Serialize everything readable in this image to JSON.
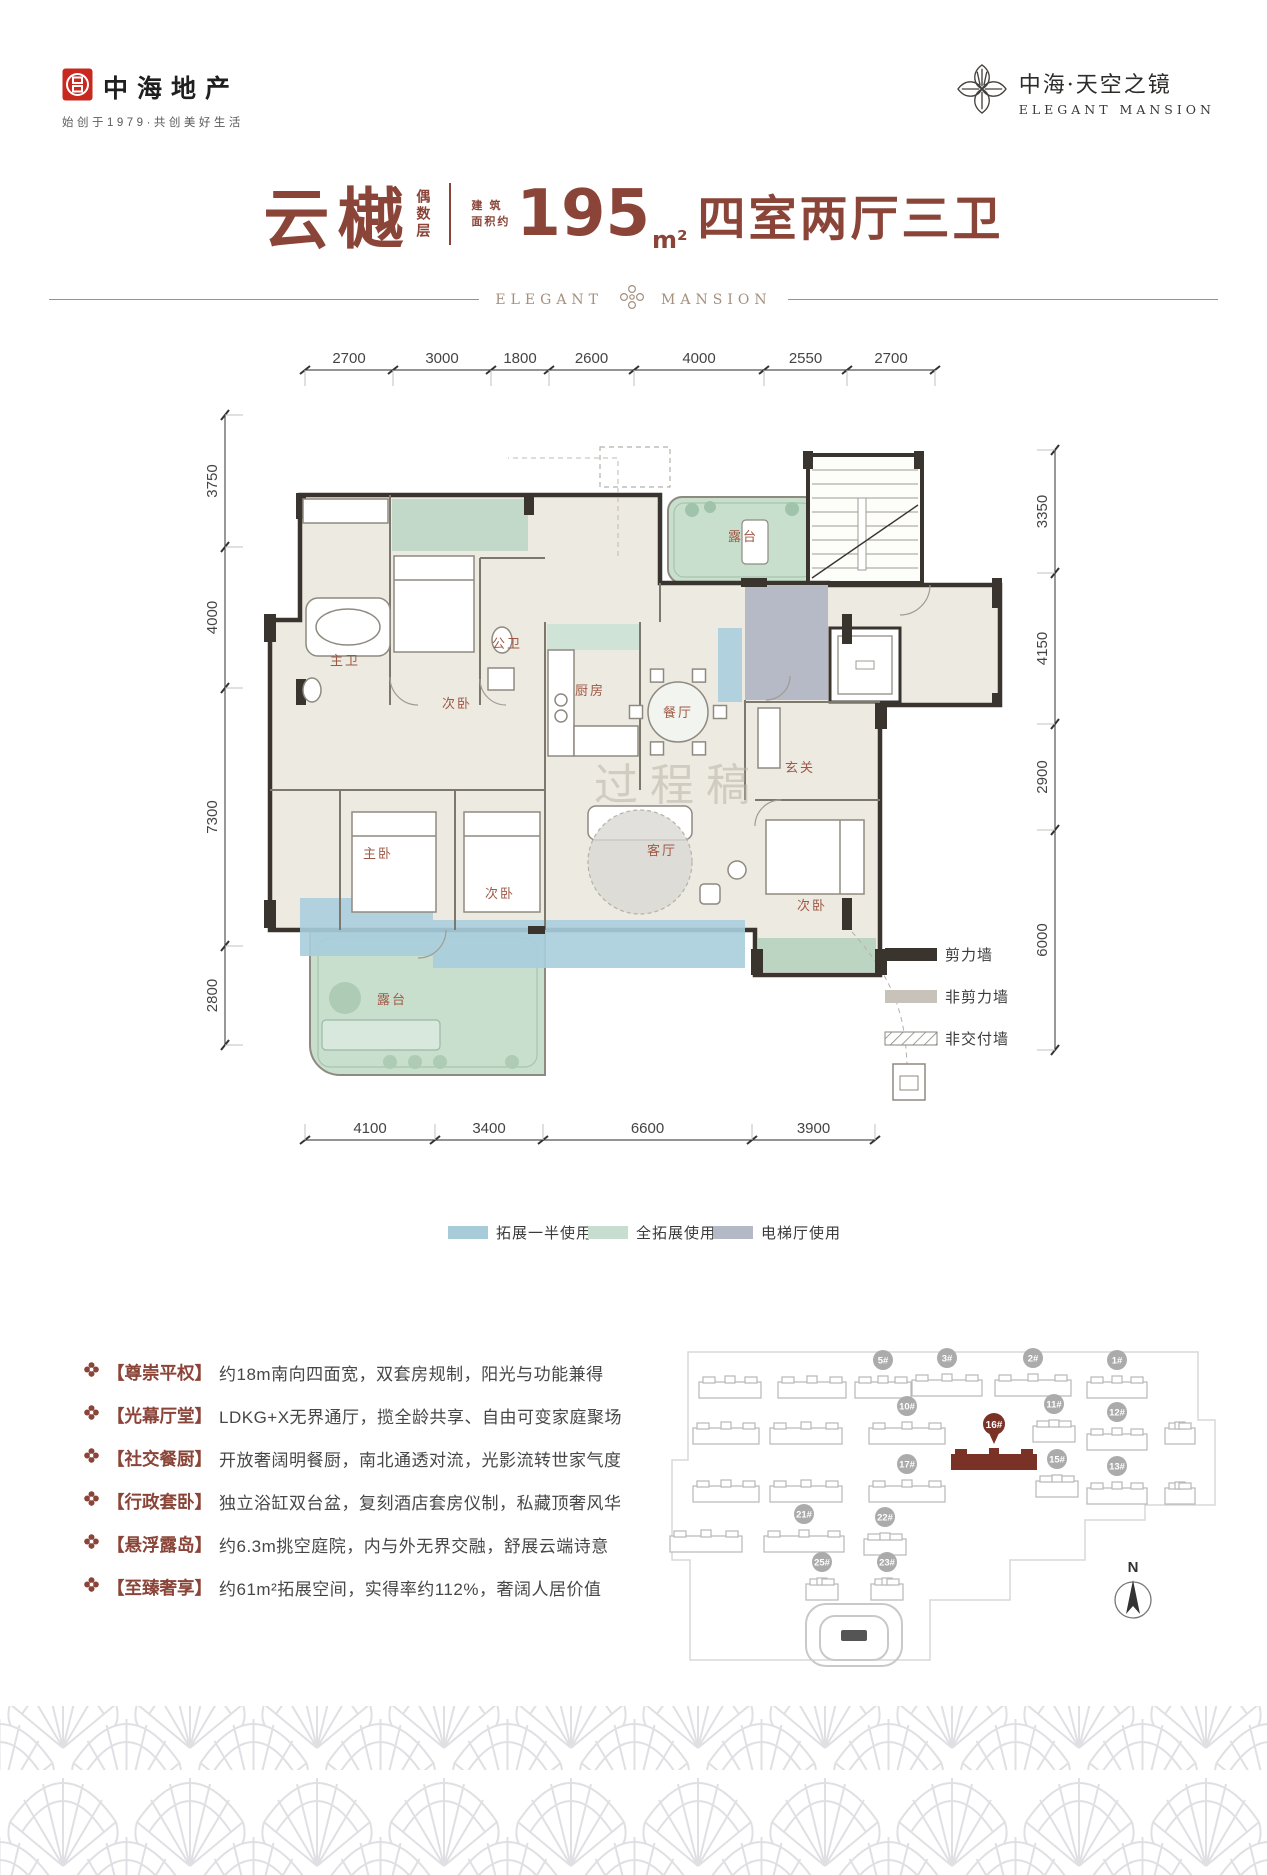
{
  "brand": {
    "name": "中海地产",
    "tagline": "始创于1979·共创美好生活"
  },
  "project": {
    "name_cn": "中海·天空之镜",
    "name_en": "ELEGANT MANSION"
  },
  "title": {
    "product": "云樾",
    "floor_note": "偶数层",
    "area_prefix_l1": "建 筑",
    "area_prefix_l2": "面积约",
    "area_value": "195",
    "area_unit": "m²",
    "layout": "四室两厅三卫",
    "banner_left": "ELEGANT",
    "banner_right": "MANSION"
  },
  "plan": {
    "watermark": "过程稿",
    "rooms": [
      "露台",
      "主卫",
      "次卧",
      "公卫",
      "厨房",
      "餐厅",
      "玄关",
      "主卧",
      "次卧",
      "客厅",
      "次卧",
      "露台"
    ],
    "dims": {
      "top": [
        "2700",
        "3000",
        "1800",
        "2600",
        "4000",
        "2550",
        "2700"
      ],
      "left": [
        "3750",
        "4000",
        "7300",
        "2800"
      ],
      "right": [
        "3350",
        "4150",
        "2900",
        "6000"
      ],
      "bottom": [
        "4100",
        "3400",
        "6600",
        "3900"
      ]
    },
    "wall_legend": [
      "剪力墙",
      "非剪力墙",
      "非交付墙"
    ],
    "zone_legend": [
      {
        "label": "拓展一半使用",
        "color": "#a8cbd9"
      },
      {
        "label": "全拓展使用",
        "color": "#c7ddd0"
      },
      {
        "label": "电梯厅使用",
        "color": "#b4b9c6"
      }
    ]
  },
  "features": [
    {
      "head": "【尊崇平权】",
      "text": "约18m南向四面宽，双套房规制，阳光与功能兼得"
    },
    {
      "head": "【光幕厅堂】",
      "text": "LDKG+X无界通厅，揽全龄共享、自由可变家庭聚场"
    },
    {
      "head": "【社交餐厨】",
      "text": "开放奢阔明餐厨，南北通透对流，光影流转世家气度"
    },
    {
      "head": "【行政套卧】",
      "text": "独立浴缸双台盆，复刻酒店套房仪制，私藏顶奢风华"
    },
    {
      "head": "【悬浮露岛】",
      "text": "约6.3m挑空庭院，内与外无界交融，舒展云端诗意"
    },
    {
      "head": "【至臻奢享】",
      "text": "约61m²拓展空间，实得率约112%，奢阔人居价值"
    }
  ],
  "siteplan": {
    "buildings": [
      {
        "label": "5#"
      },
      {
        "label": "3#"
      },
      {
        "label": "2#"
      },
      {
        "label": "1#"
      },
      {
        "label": "10#"
      },
      {
        "label": "11#"
      },
      {
        "label": "12#"
      },
      {
        "label": "16#",
        "highlight": true
      },
      {
        "label": "17#"
      },
      {
        "label": "15#"
      },
      {
        "label": "13#"
      },
      {
        "label": "21#"
      },
      {
        "label": "22#"
      },
      {
        "label": "25#"
      },
      {
        "label": "23#"
      }
    ],
    "compass": "N",
    "highlight_color": "#7a3226"
  }
}
